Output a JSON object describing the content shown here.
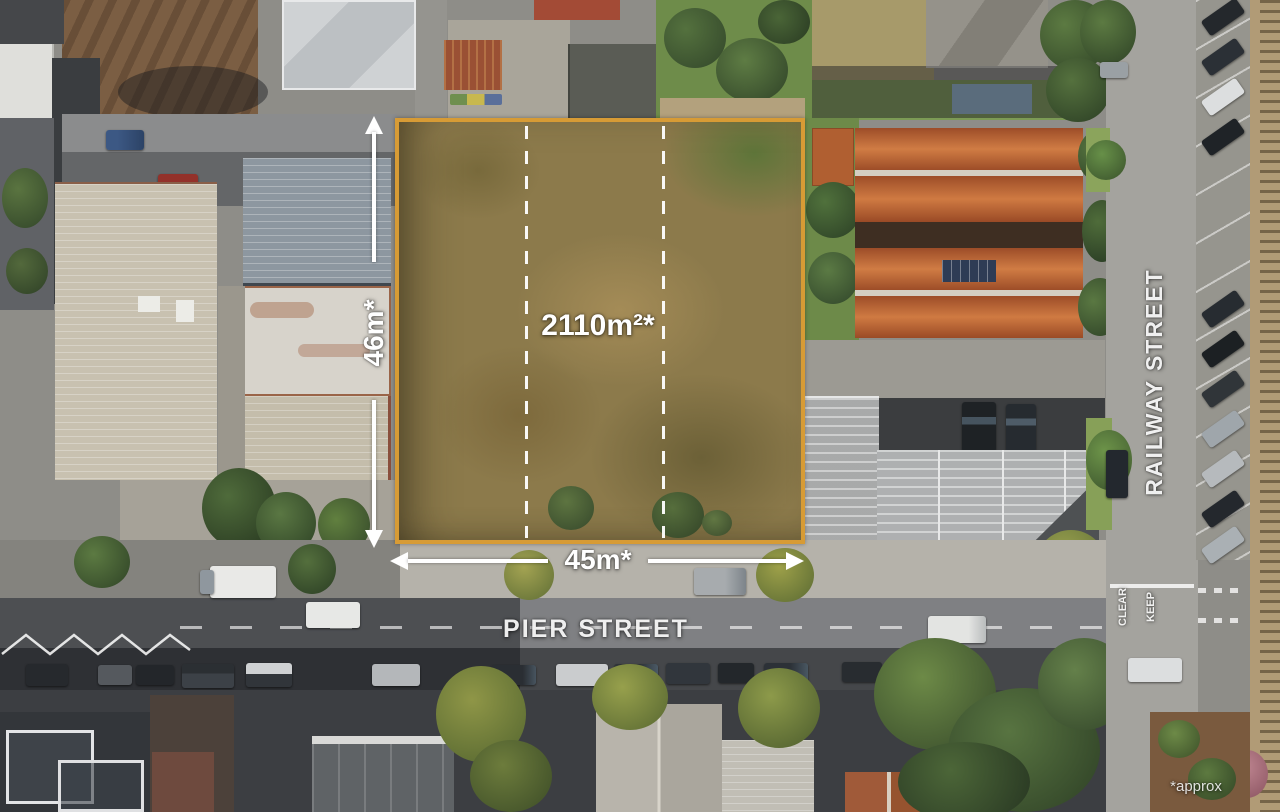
{
  "image": {
    "type": "annotated aerial real-estate photo",
    "subject": "vacant corner development site at Pier Street and Railway Street"
  },
  "site": {
    "area_label": "2110m²*",
    "frontage_label": "45m*",
    "depth_label": "46m*"
  },
  "streets": {
    "pier": "PIER STREET",
    "railway": "RAILWAY STREET"
  },
  "road_markings": {
    "keep": "KEEP",
    "clear": "CLEAR"
  },
  "footnote": {
    "approx": "*approx"
  },
  "colors": {
    "boundary_outline": "#D79B35",
    "lot_dividers": "#FFFFFF",
    "annotation_text": "#FFFFFF",
    "lot_grass": "#8C7A4B",
    "terracotta_roof": "#BD6130",
    "commercial_roof": "#B9BBBC",
    "road_surface": "#7F8083",
    "railway_ballast": "#B19B76"
  }
}
